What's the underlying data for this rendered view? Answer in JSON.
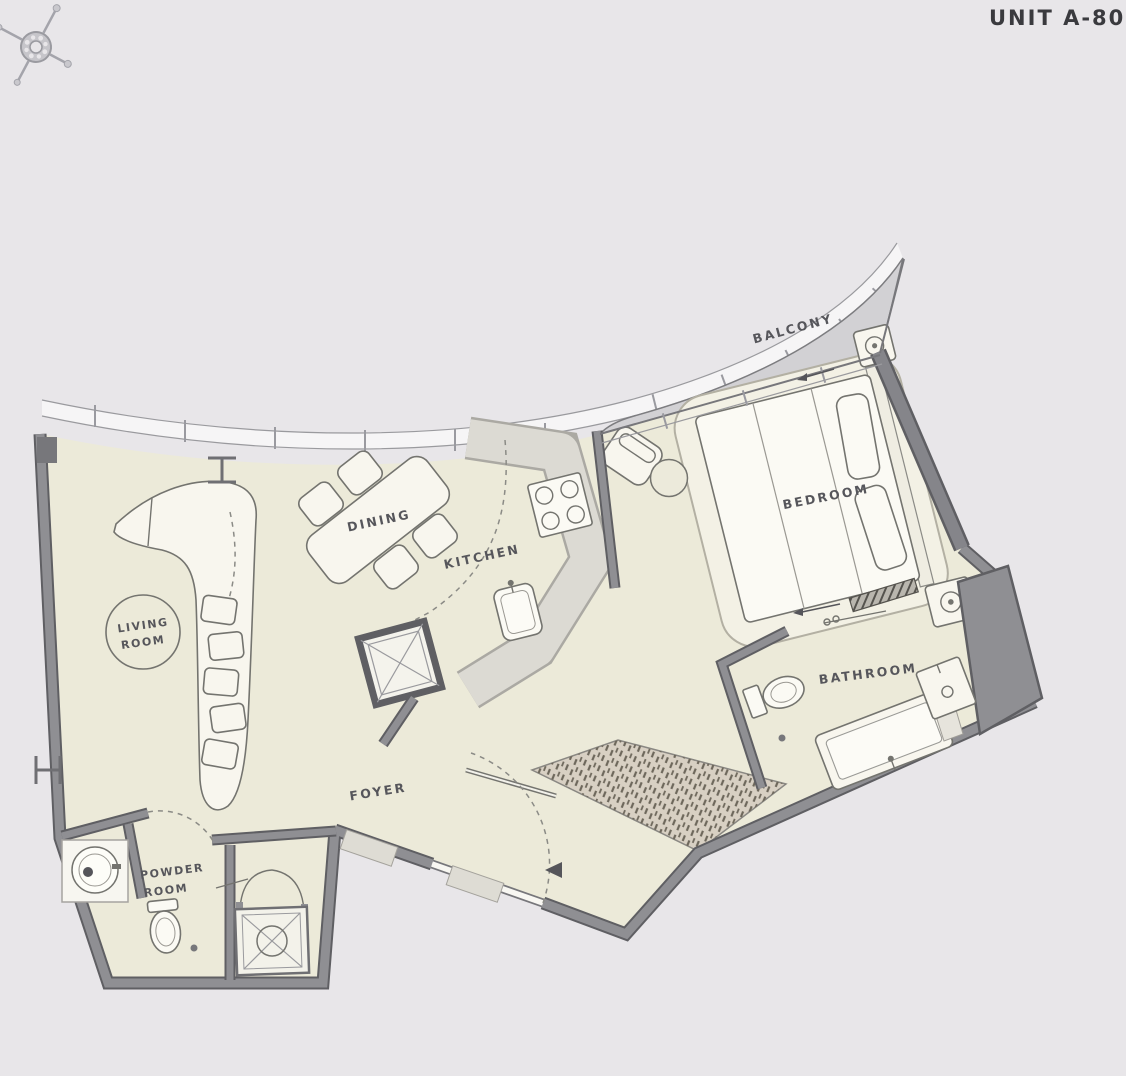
{
  "title": "UNIT A-808",
  "compass": "compass-rose",
  "rooms": {
    "balcony": "BALCONY",
    "bedroom": "BEDROOM",
    "living1": "LIVING",
    "living2": "ROOM",
    "dining": "DINING",
    "kitchen": "KITCHEN",
    "bathroom": "BATHROOM",
    "foyer": "FOYER",
    "powder1": "POWDER",
    "powder2": "ROOM"
  },
  "colors": {
    "background": "#e8e6e9",
    "floor": "#ecead9",
    "wall": "#8f8f93",
    "wall_edge": "#5f5f63",
    "balcony": "#d2d1d4",
    "counter": "#dcdad3",
    "wardrobe": "#d8d0c3",
    "furniture": "#f8f6ee",
    "carpet": "#f3f1e5",
    "outline": "#74746f",
    "label": "#56565b",
    "title": "#3a3a3e"
  }
}
